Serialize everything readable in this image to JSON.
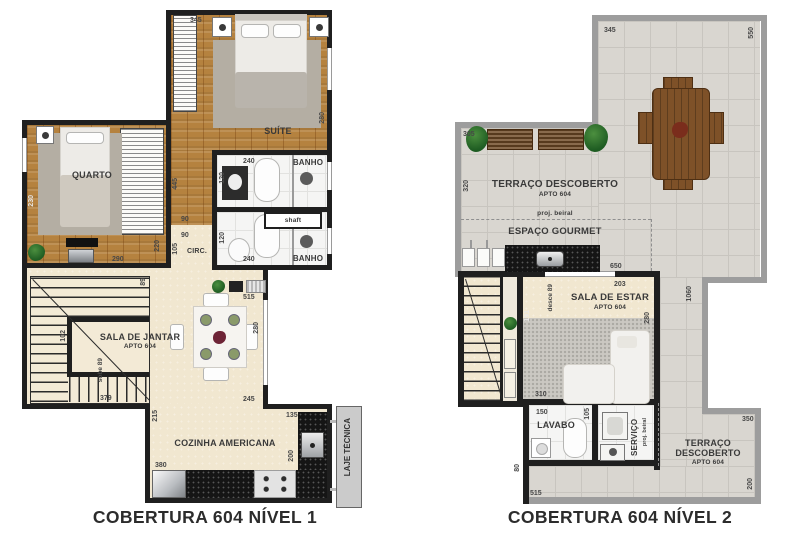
{
  "palette": {
    "wall_black": "#1f1f1f",
    "wall_gray": "#9d9d9d",
    "wood_floor": "#b5823f",
    "cream_floor": "#f1e7d0",
    "pavement": "#d9d6d0",
    "granite": "#151515",
    "plant_green": "#2e7d32",
    "label_color": "#3a3a3a"
  },
  "plan1": {
    "title": "COBERTURA 604 NÍVEL 1",
    "labels": {
      "suite": "SUÍTE",
      "quarto": "QUARTO",
      "banho1": "BANHO",
      "banho2": "BANHO",
      "circ": "CIRC.",
      "shaft": "shaft",
      "sala": "SALA DE JANTAR",
      "sala_sub": "APTO 604",
      "sobe": "sobe 89",
      "cozinha": "COZINHA AMERICANA",
      "laje": "LAJE TÉCNICA"
    },
    "dims": {
      "suite_w": "345",
      "suite_d": "280",
      "banho_w1": "240",
      "banho_d1": "120",
      "banho_d2": "120",
      "banho_w2": "240",
      "hall": "445",
      "circ_w1": "90",
      "circ_w2": "90",
      "circ_d": "105",
      "quarto_l": "230",
      "quarto_w": "290",
      "quarto_r": "220",
      "stair_entry": "89",
      "stair_side": "102",
      "stair_w": "379",
      "sala_step": "215",
      "sala_w": "515",
      "sala_d": "280",
      "coz_w": "245",
      "coz_ext": "135",
      "coz_r": "200",
      "coz_b": "380"
    }
  },
  "plan2": {
    "title": "COBERTURA 604 NÍVEL 2",
    "labels": {
      "terraco_top": "TERRAÇO DESCOBERTO",
      "terraco_top_sub": "APTO 604",
      "beiral_top": "proj. beiral",
      "gourmet": "ESPAÇO GOURMET",
      "sala": "SALA DE ESTAR",
      "sala_sub": "APTO 604",
      "desce": "desce 89",
      "lavabo": "LAVABO",
      "servico": "SERVIÇO",
      "beiral_side": "proj. beiral",
      "terraco_b1": "TERRAÇO",
      "terraco_b2": "DESCOBERTO",
      "terraco_b_sub": "APTO 604"
    },
    "dims": {
      "top": "345",
      "right": "550",
      "ext_top": "305",
      "ext_left": "320",
      "gourmet": "650",
      "strip": "1060",
      "sala_w": "203",
      "sala_d": "280",
      "stair_strip": "191",
      "sala_b": "310",
      "lavabo_w": "150",
      "lavabo_d": "105",
      "terr2_w": "350",
      "terr2_d": "200",
      "band_d": "80",
      "bottom": "515"
    }
  }
}
